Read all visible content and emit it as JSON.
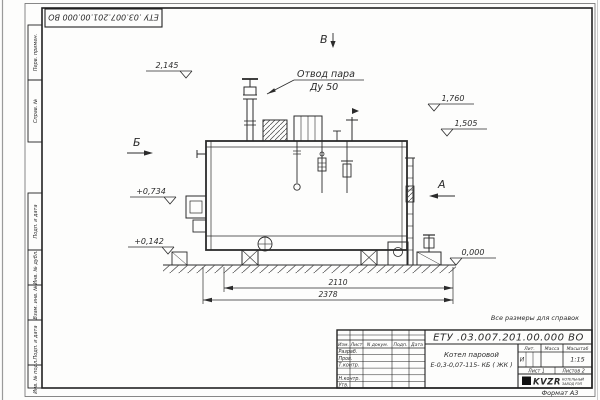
{
  "sheet": {
    "doc_number": "ЕТУ .03.007.201.00.000  ВО",
    "note": "Все размеры для справок",
    "format_label": "Формат А3"
  },
  "margin_stamps": {
    "items": [
      "Перв. примен.",
      "Справ. №",
      "Подп. и дата",
      "Инв. № дубл.",
      "Взам. инв. №",
      "Подп. и дата",
      "Инв. № подл."
    ]
  },
  "title_block": {
    "doc_number": "ЕТУ .03.007.201.00.000  ВО",
    "product_line1": "Котел паровой",
    "product_line2": "Е-0,3-0,07-115- КБ ( ЖК )",
    "columns": {
      "izm": "Изм.",
      "list": "Лист",
      "doc": "N докум.",
      "podp": "Подп.",
      "data": "Дата"
    },
    "rows": {
      "razrab": "Разраб.",
      "prov": "Пров.",
      "tkontr": "Т.контр.",
      "nkontr": "Н.контр.",
      "utv": "Утв."
    },
    "lit_header": "Лит.",
    "lit_value": "И",
    "mass_header": "Масса",
    "scale_header": "Масштаб",
    "scale_value": "1:15",
    "sheet_text": "Лист 1",
    "sheets_text": "Листов 2",
    "logo_text": "KVZR",
    "logo_caption_line1": "КОТЕЛЬНЫЙ",
    "logo_caption_line2": "ЗАВОД РЭП"
  },
  "drawing": {
    "callout": {
      "line1": "Отвод пара",
      "line2": "Ду 50"
    },
    "views": {
      "top": "В",
      "left": "Б",
      "right": "А"
    },
    "elevations": {
      "top": "2,145",
      "right_upper": "1,760",
      "right_lower": "1,505",
      "left_upper": "+0,734",
      "left_lower": "+0,142",
      "ground": "0,000"
    },
    "dimensions": {
      "inner": "2110",
      "outer": "2378"
    }
  }
}
